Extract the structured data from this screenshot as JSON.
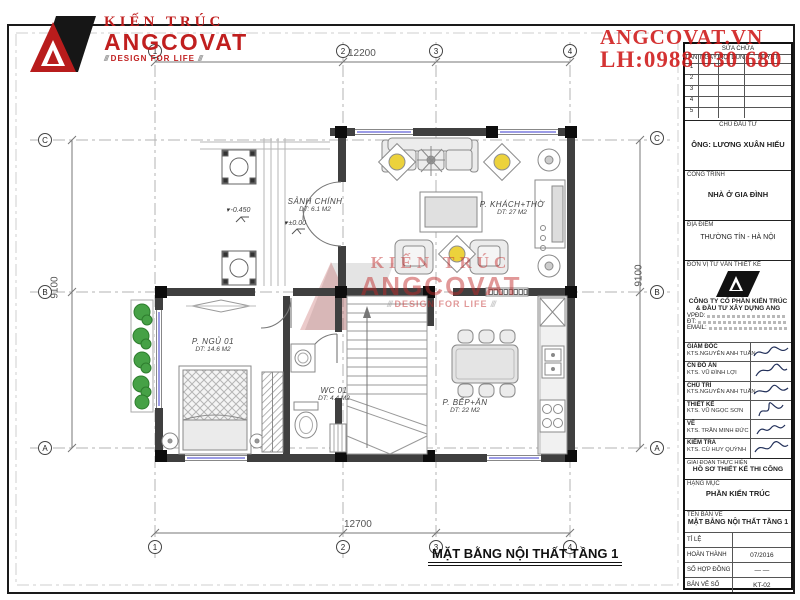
{
  "brand": {
    "kien_truc": "KIẾN TRÚC",
    "name": "ANGCOVAT",
    "tagline": "DESIGN FOR LIFE",
    "website": "ANGCOVAT.VN",
    "hotline": "LH:0988 030 680"
  },
  "watermark": {
    "line1": "KIẾN TRÚC",
    "line2": "ANGCOVAT",
    "line3": "DESIGN FOR LIFE"
  },
  "title_block": {
    "revision": {
      "title": "SỬA CHỮA",
      "columns": [
        "LẦN",
        "NGÀY",
        "NỘI DUNG",
        "DUYỆT"
      ],
      "rows": [
        "1",
        "2",
        "3",
        "4",
        "5"
      ]
    },
    "owner": {
      "label": "CHỦ ĐẦU TƯ",
      "value": "ÔNG: LƯƠNG XUÂN HIẾU"
    },
    "project": {
      "label": "CÔNG TRÌNH",
      "value": "NHÀ Ở GIA ĐÌNH"
    },
    "location": {
      "label": "ĐỊA ĐIỂM",
      "value": "THƯỜNG TÍN - HÀ NỘI"
    },
    "consultant": {
      "label": "ĐƠN VỊ TƯ VẤN THIẾT KẾ",
      "company_line1": "CÔNG TY CỔ PHẦN KIẾN TRÚC",
      "company_line2": "& ĐẦU TƯ XÂY DỰNG ANG",
      "contact1": "VPĐD:",
      "contact2": "ĐT:",
      "contact3": "EMAIL:"
    },
    "signatures": [
      {
        "role": "GIÁM ĐỐC",
        "name": "KTS.NGUYỄN ANH TUẤN"
      },
      {
        "role": "CN ĐỒ ÁN",
        "name": "KTS. VŨ ĐÌNH LỢI"
      },
      {
        "role": "CHỦ TRÌ",
        "name": "KTS.NGUYỄN ANH TUẤN"
      },
      {
        "role": "THIẾT KẾ",
        "name": "KTS. VŨ NGỌC SƠN"
      },
      {
        "role": "VẼ",
        "name": "KTS. TRẦN MINH ĐỨC"
      },
      {
        "role": "KIỂM TRA",
        "name": "KTS. CÙ HUY QUỲNH"
      }
    ],
    "phase": {
      "label": "GIAI ĐOẠN THỰC HIỆN",
      "value": "HỒ SƠ THIẾT KẾ THI CÔNG"
    },
    "category": {
      "label": "HẠNG MỤC",
      "value": "PHẦN KIẾN TRÚC"
    },
    "drawing": {
      "label": "TÊN BẢN VẼ",
      "value": "MẶT BẰNG NỘI THẤT TẦNG 1"
    },
    "info": [
      {
        "label": "TỈ LỆ",
        "value": ""
      },
      {
        "label": "HOÀN THÀNH",
        "value": "07/2016"
      },
      {
        "label": "SỐ HỢP ĐỒNG",
        "value": "—  —"
      },
      {
        "label": "BẢN VẼ SỐ",
        "value": "KT-02"
      }
    ]
  },
  "plan": {
    "title": "MẶT BẰNG NỘI THẤT TẦNG 1",
    "rooms": {
      "hall": {
        "name": "SẢNH CHÍNH",
        "area": "DT: 6.1 M2"
      },
      "living": {
        "name": "P. KHÁCH+THỜ",
        "area": "DT: 27 M2"
      },
      "bedroom": {
        "name": "P. NGỦ 01",
        "area": "DT: 14.6 M2"
      },
      "wc": {
        "name": "WC 01",
        "area": "DT: 4.4 M2"
      },
      "kitchen": {
        "name": "P. BẾP+ĂN",
        "area": "DT: 22 M2"
      }
    },
    "levels": {
      "entry": "-0.450",
      "main": "±0.00"
    },
    "dims": {
      "top": "12200",
      "bottom": "12700",
      "left": "9100",
      "right": "9100"
    },
    "grid": {
      "c1": "1",
      "c2": "2",
      "c3": "3",
      "c4": "4",
      "rA": "A",
      "rB": "B",
      "rC": "C"
    }
  }
}
